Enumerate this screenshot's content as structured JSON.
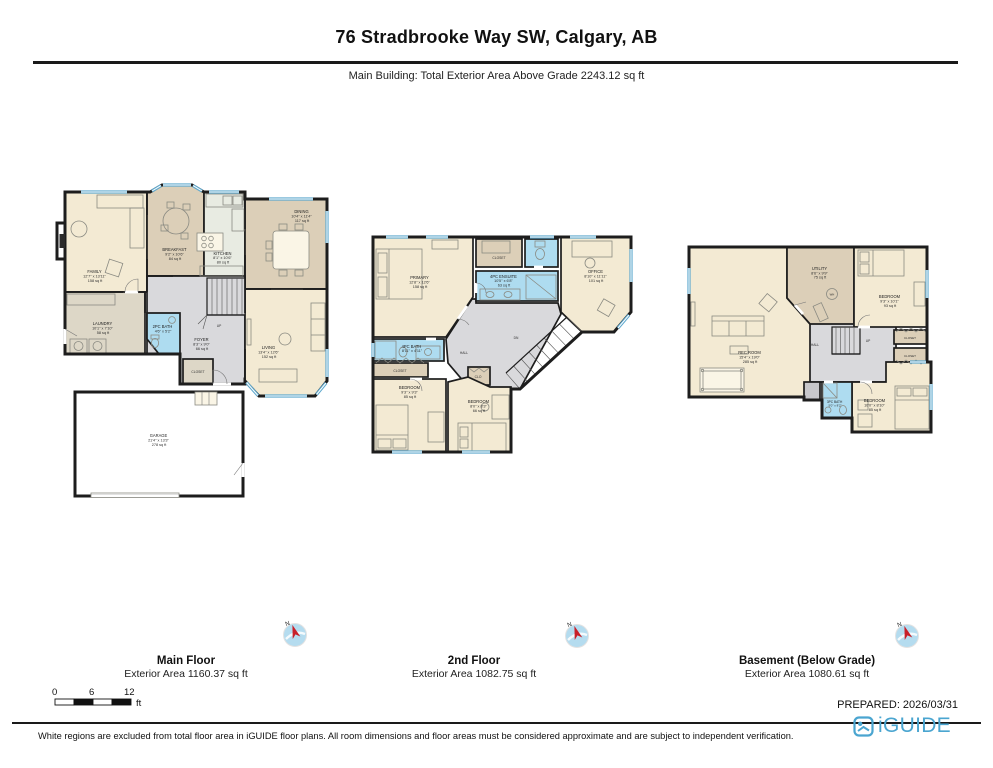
{
  "header": {
    "title": "76 Stradbrooke Way SW, Calgary, AB",
    "subtitle": "Main Building: Total Exterior Area Above Grade 2243.12 sq ft"
  },
  "footer": {
    "prepared": "PREPARED: 2026/03/31",
    "disclaimer": "White regions are excluded from total floor area in iGUIDE floor plans. All room dimensions and floor areas must be considered approximate and are subject to independent verification.",
    "brand": "iGUIDE"
  },
  "scale_bar": {
    "t0": "0",
    "t1": "6",
    "t2": "12",
    "unit": "ft"
  },
  "compass": {
    "north": "N"
  },
  "colors": {
    "wall": "#1d1d1d",
    "room_cream": "#f3ead3",
    "room_tan": "#dccfb8",
    "bath_blue": "#aedcf0",
    "hall_gray": "#d9d9dc",
    "window_blue": "#5fa9ce",
    "brand_blue": "#4aa5d0"
  },
  "floors": [
    {
      "name": "Main Floor",
      "area": "Exterior Area 1160.37 sq ft",
      "rooms": {
        "family": {
          "label": "FAMILY",
          "dims": "12'7\" x 13'11\"",
          "area": "158 sq ft"
        },
        "breakfast": {
          "label": "BREAKFAST",
          "dims": "9'2\" x 10'6\"",
          "area": "84 sq ft"
        },
        "kitchen": {
          "label": "KITCHEN",
          "dims": "8'1\" x 10'6\"",
          "area": "80 sq ft"
        },
        "dining": {
          "label": "DINING",
          "dims": "10'4\" x 11'4\"",
          "area": "117 sq ft"
        },
        "laundry": {
          "label": "LAUNDRY",
          "dims": "10'1\" x 7'10\"",
          "area": "58 sq ft"
        },
        "bath": {
          "label": "2PC BATH",
          "dims": "4'6\" x 5'2\""
        },
        "foyer": {
          "label": "FOYER",
          "dims": "8'3\" x 9'0\"",
          "area": "66 sq ft"
        },
        "closet": {
          "label": "CLOSET"
        },
        "living": {
          "label": "LIVING",
          "dims": "13'4\" x 12'6\"",
          "area": "152 sq ft"
        },
        "garage": {
          "label": "GARAGE",
          "dims": "21'4\" x 13'3\"",
          "area": "278 sq ft"
        },
        "up": {
          "label": "UP"
        }
      }
    },
    {
      "name": "2nd Floor",
      "area": "Exterior Area 1082.75 sq ft",
      "rooms": {
        "primary": {
          "label": "PRIMARY",
          "dims": "12'8\" x 12'6\"",
          "area": "158 sq ft"
        },
        "closet": {
          "label": "CLOSET"
        },
        "ensuite": {
          "label": "4PC ENSUITE",
          "dims": "10'5\" x 6'8\"",
          "area": "63 sq ft"
        },
        "office": {
          "label": "OFFICE",
          "dims": "8'10\" x 11'11\"",
          "area": "101 sq ft"
        },
        "bath": {
          "label": "4PC BATH",
          "dims": "8'11\" x 4'11\""
        },
        "closet2": {
          "label": "CLOSET"
        },
        "bedroom_a": {
          "label": "BEDROOM",
          "dims": "9'3\" x 9'3\"",
          "area": "85 sq ft"
        },
        "bedroom_b": {
          "label": "BEDROOM",
          "dims": "8'0\" x 8'3\"",
          "area": "66 sq ft"
        },
        "hall": {
          "label": "HALL"
        },
        "clo": {
          "label": "CLO"
        },
        "dn": {
          "label": "DN"
        }
      }
    },
    {
      "name": "Basement (Below Grade)",
      "area": "Exterior Area 1080.61 sq ft",
      "rooms": {
        "rec": {
          "label": "REC ROOM",
          "dims": "15'4\" x 19'0\"",
          "area": "285 sq ft"
        },
        "utility": {
          "label": "UTILITY",
          "dims": "8'6\" x 9'9\"",
          "area": "75 sq ft"
        },
        "bedroom_a": {
          "label": "BEDROOM",
          "dims": "9'3\" x 10'1\"",
          "area": "93 sq ft"
        },
        "closet": {
          "label": "CLOSET"
        },
        "closet2": {
          "label": "CLOSET"
        },
        "bedroom_b": {
          "label": "BEDROOM",
          "dims": "10'0\" x 8'10\"",
          "area": "85 sq ft"
        },
        "bath": {
          "label": "3PC BATH",
          "dims": "5'0\" x 8'2\""
        },
        "hall": {
          "label": "HALL"
        },
        "up": {
          "label": "UP"
        },
        "wh": {
          "label": "WH"
        }
      }
    }
  ]
}
